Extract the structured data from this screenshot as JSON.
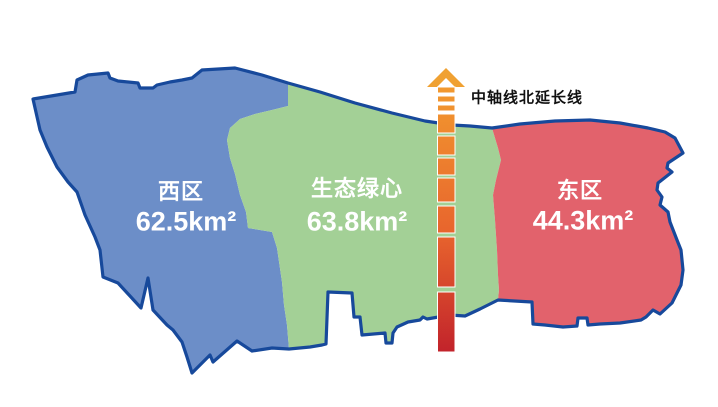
{
  "map": {
    "outline_color": "#17499B",
    "background_color": "#FFFFFF",
    "regions": [
      {
        "id": "west",
        "name": "西区",
        "area": "62.5km²",
        "color": "#6C8EC8"
      },
      {
        "id": "green-heart",
        "name": "生态绿心",
        "area": "63.8km²",
        "color": "#A3D096"
      },
      {
        "id": "east",
        "name": "东区",
        "area": "44.3km²",
        "color": "#E2626C"
      }
    ],
    "axis": {
      "label": "中轴线北延长线",
      "arrow_color": "#F0A132",
      "dash_gradient_top": "#F29A2F",
      "dash_gradient_mid": "#E8652D",
      "dash_gradient_bottom": "#C2232B",
      "dash_border_color": "#FFFFFF"
    }
  }
}
